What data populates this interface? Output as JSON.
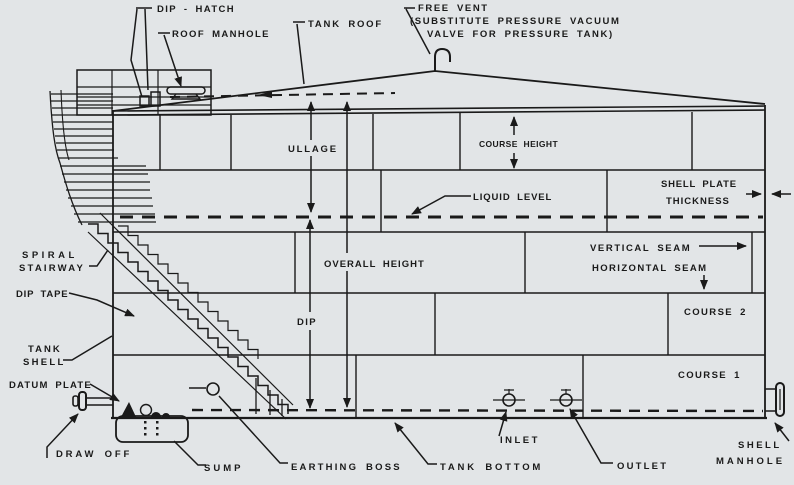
{
  "colors": {
    "background": "#e2e5e7",
    "ink": "#1a1a1a"
  },
  "labels": {
    "dip_hatch": "DIP - HATCH",
    "roof_manhole": "ROOF MANHOLE",
    "tank_roof": "TANK ROOF",
    "free_vent_1": "FREE VENT",
    "free_vent_2": "(SUBSTITUTE PRESSURE VACUUM",
    "free_vent_3": "VALVE FOR PRESSURE TANK)",
    "ullage": "ULLAGE",
    "course_height": "COURSE HEIGHT",
    "liquid_level": "LIQUID LEVEL",
    "shell_plate_1": "SHELL PLATE",
    "shell_plate_2": "THICKNESS",
    "vertical_seam": "VERTICAL SEAM",
    "horizontal_seam": "HORIZONTAL SEAM",
    "overall_height": "OVERALL HEIGHT",
    "spiral_stairway_1": "SPIRAL",
    "spiral_stairway_2": "STAIRWAY",
    "dip_tape": "DIP TAPE",
    "dip": "DIP",
    "course_2": "COURSE 2",
    "tank_shell_1": "TANK",
    "tank_shell_2": "SHELL",
    "course_1": "COURSE 1",
    "datum_plate": "DATUM PLATE",
    "draw_off": "DRAW OFF",
    "sump": "SUMP",
    "earthing_boss": "EARTHING BOSS",
    "tank_bottom": "TANK BOTTOM",
    "inlet": "INLET",
    "outlet": "OUTLET",
    "shell_manhole_1": "SHELL",
    "shell_manhole_2": "MANHOLE"
  }
}
